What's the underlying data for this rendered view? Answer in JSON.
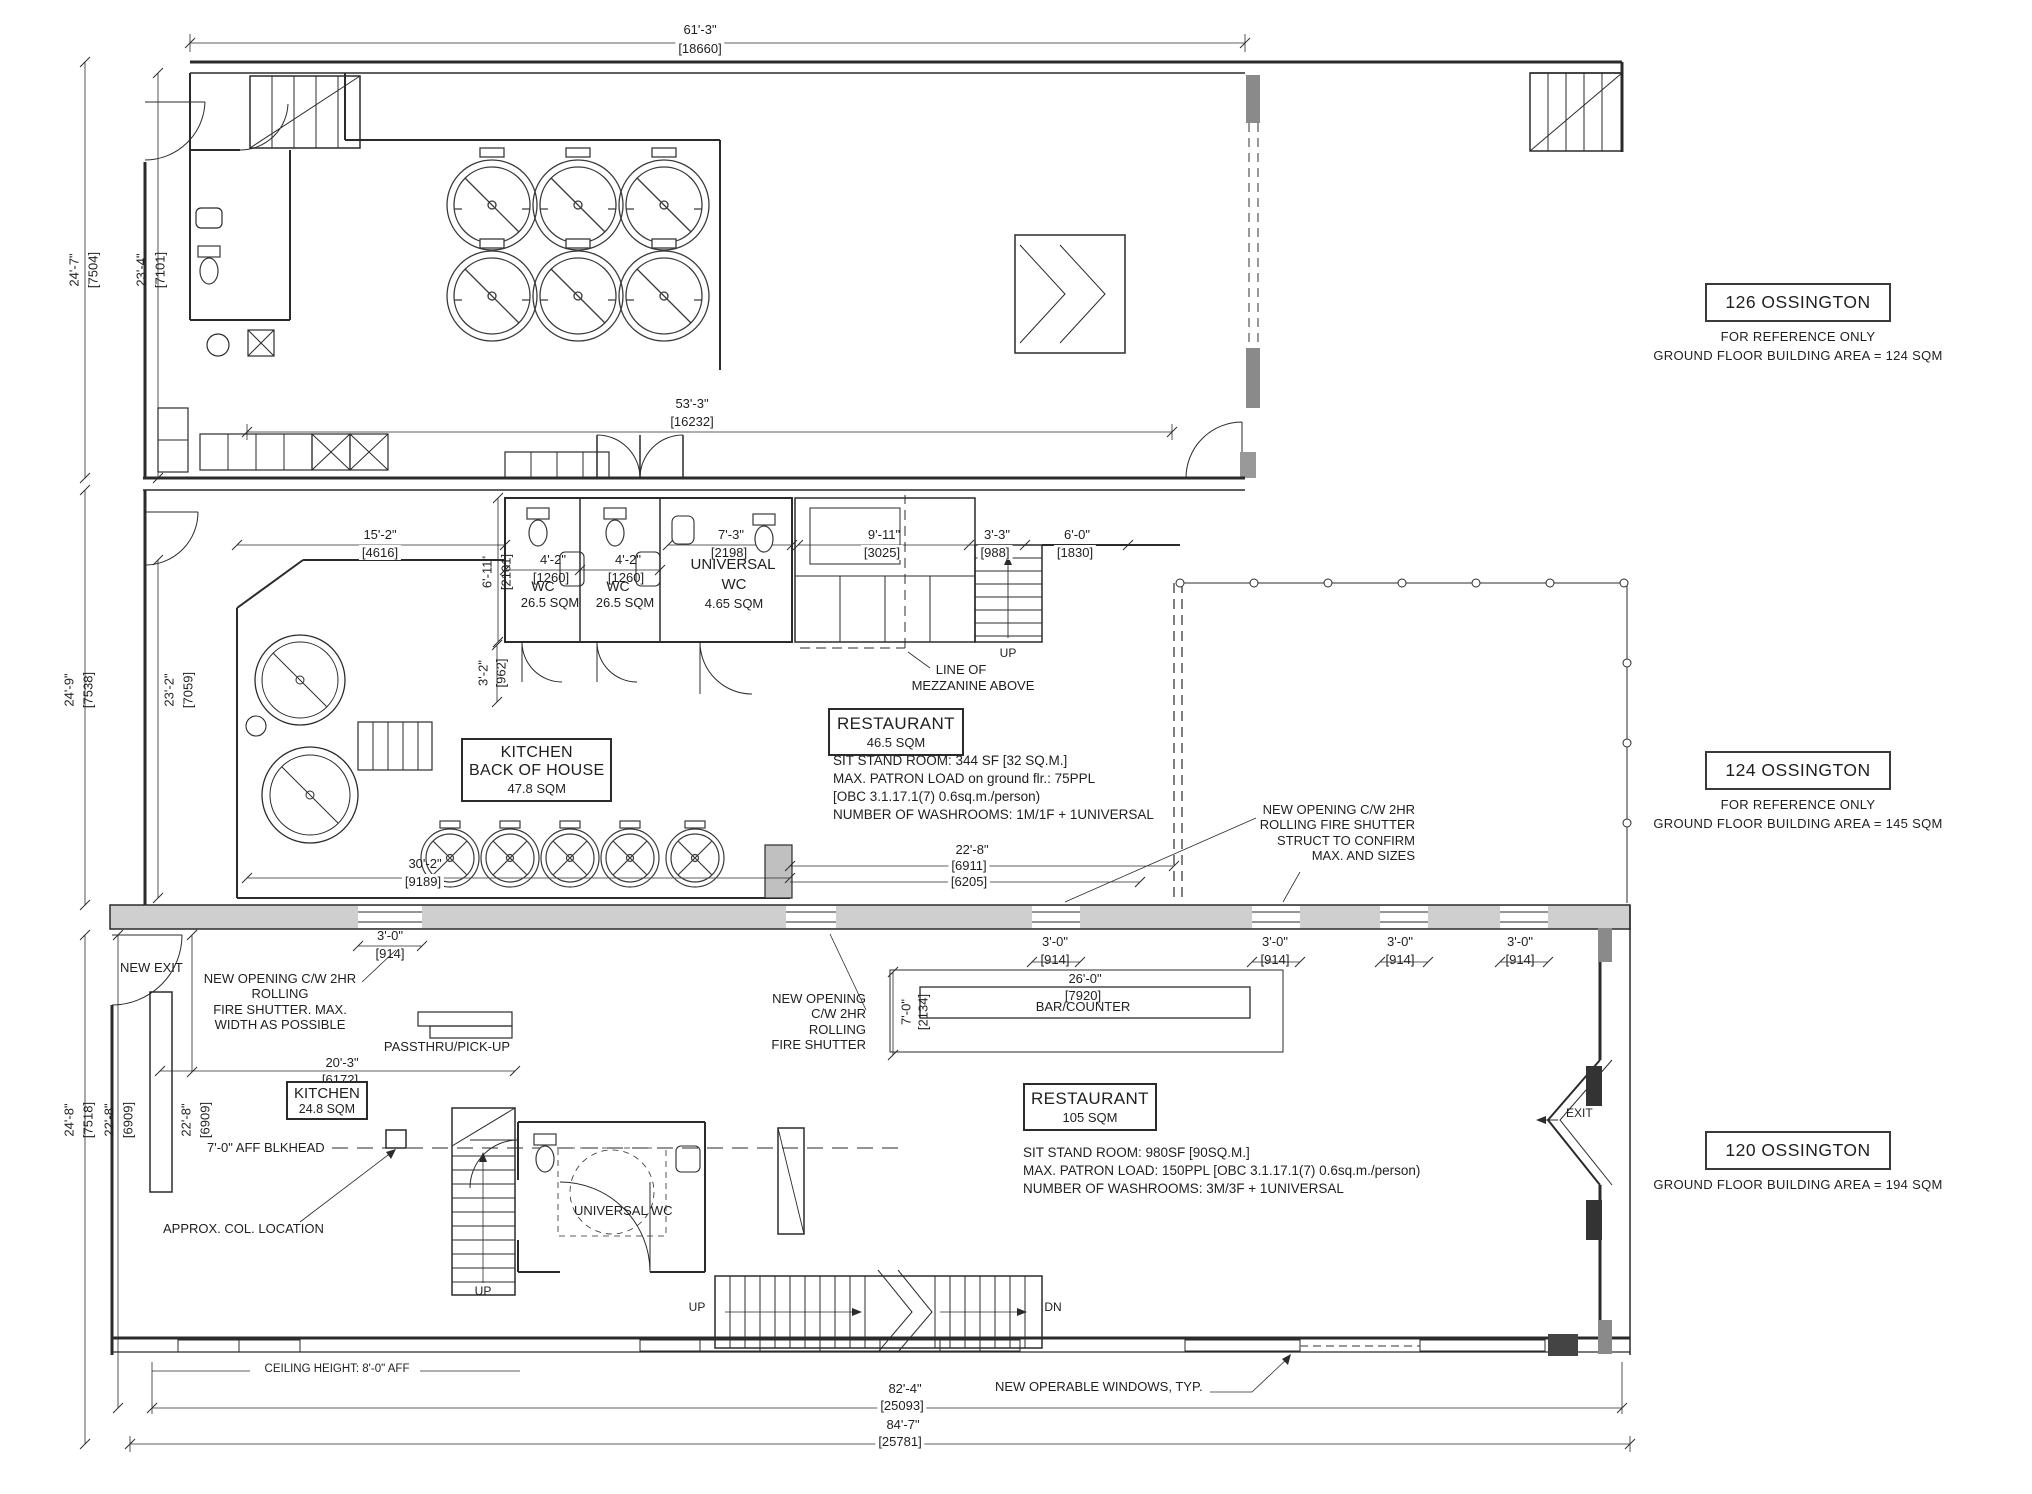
{
  "units": {
    "u126": {
      "name": "126 OSSINGTON",
      "ref": "FOR REFERENCE ONLY",
      "area": "GROUND FLOOR BUILDING AREA = 124 SQM"
    },
    "u124": {
      "name": "124 OSSINGTON",
      "ref": "FOR REFERENCE ONLY",
      "area": "GROUND FLOOR BUILDING AREA = 145 SQM"
    },
    "u120": {
      "name": "120 OSSINGTON",
      "area": "GROUND FLOOR BUILDING AREA = 194 SQM"
    }
  },
  "rooms": {
    "restaurant124": {
      "title": "RESTAURANT",
      "area": "46.5 SQM"
    },
    "restaurant120": {
      "title": "RESTAURANT",
      "area": "105 SQM"
    },
    "kitchen_boh": {
      "l1": "KITCHEN",
      "l2": "BACK OF HOUSE",
      "area": "47.8 SQM"
    },
    "kitchen120": {
      "title": "KITCHEN",
      "area": "24.8 SQM"
    },
    "wc": {
      "title": "WC",
      "area": "26.5 SQM"
    },
    "uwc124": {
      "l1": "UNIVERSAL",
      "l2": "WC",
      "area": "4.65 SQM"
    },
    "uwc120": {
      "title": "UNIVERSAL WC"
    },
    "bar": {
      "title": "BAR/COUNTER"
    }
  },
  "notes": {
    "n124": [
      "SIT STAND ROOM: 344 SF [32 SQ.M.]",
      "MAX. PATRON LOAD on ground flr.: 75PPL",
      "[OBC 3.1.17.1(7) 0.6sq.m./person)",
      "NUMBER OF WASHROOMS: 1M/1F + 1UNIVERSAL"
    ],
    "n120": [
      "SIT STAND ROOM: 980SF [90SQ.M.]",
      "MAX. PATRON LOAD: 150PPL [OBC 3.1.17.1(7) 0.6sq.m./person)",
      "NUMBER OF WASHROOMS: 3M/3F + 1UNIVERSAL"
    ],
    "shutter_struct": [
      "NEW OPENING C/W 2HR",
      "ROLLING FIRE SHUTTER",
      "STRUCT TO CONFIRM",
      "MAX. AND SIZES"
    ],
    "shutter_left": [
      "NEW OPENING C/W 2HR",
      "ROLLING",
      "FIRE SHUTTER. MAX.",
      "WIDTH AS POSSIBLE"
    ],
    "shutter_bar": [
      "NEW OPENING",
      "C/W 2HR",
      "ROLLING",
      "FIRE SHUTTER"
    ],
    "mezz1": "LINE OF",
    "mezz2": "MEZZANINE ABOVE",
    "new_exit": "NEW EXIT",
    "passthru": "PASSTHRU/PICK-UP",
    "blkhead": "7'-0\" AFF BLKHEAD",
    "col": "APPROX. COL. LOCATION",
    "windows": "NEW OPERABLE WINDOWS, TYP.",
    "ceiling": "CEILING HEIGHT: 8'-0\" AFF",
    "up": "UP",
    "dn": "DN",
    "exit": "EXIT"
  },
  "dims": {
    "w61_3": {
      "ft": "61'-3\"",
      "mm": "[18660]"
    },
    "w53_3": {
      "ft": "53'-3\"",
      "mm": "[16232]"
    },
    "h24_7": {
      "ft": "24'-7\"",
      "mm": "[7504]"
    },
    "h23_4": {
      "ft": "23'-4\"",
      "mm": "[7101]"
    },
    "h24_9": {
      "ft": "24'-9\"",
      "mm": "[7538]"
    },
    "h23_2": {
      "ft": "23'-2\"",
      "mm": "[7059]"
    },
    "h24_8": {
      "ft": "24'-8\"",
      "mm": "[7518]"
    },
    "h22_8": {
      "ft": "22'-8\"",
      "mm": "[6909]"
    },
    "w15_2": {
      "ft": "15'-2\"",
      "mm": "[4616]"
    },
    "h6_11": {
      "ft": "6'-11\"",
      "mm": "[2101]"
    },
    "w4_2": {
      "ft": "4'-2\"",
      "mm": "[1260]"
    },
    "w7_3": {
      "ft": "7'-3\"",
      "mm": "[2198]"
    },
    "w9_11": {
      "ft": "9'-11\"",
      "mm": "[3025]"
    },
    "w3_3": {
      "ft": "3'-3\"",
      "mm": "[988]"
    },
    "w6_0": {
      "ft": "6'-0\"",
      "mm": "[1830]"
    },
    "h3_2": {
      "ft": "3'-2\"",
      "mm": "[962]"
    },
    "w30_2": {
      "ft": "30'-2\"",
      "mm": "[9189]"
    },
    "w22_8b": {
      "ft": "22'-8\"",
      "mm": "[6911]",
      "mm2": "[6205]"
    },
    "w3_0": {
      "ft": "3'-0\"",
      "mm": "[914]"
    },
    "w26_0": {
      "ft": "26'-0\"",
      "mm": "[7920]"
    },
    "h7_0": {
      "ft": "7'-0\"",
      "mm": "[2134]"
    },
    "w20_3": {
      "ft": "20'-3\"",
      "mm": "[6172]"
    },
    "w82_4": {
      "ft": "82'-4\"",
      "mm": "[25093]"
    },
    "w84_7": {
      "ft": "84'-7\"",
      "mm": "[25781]"
    }
  },
  "colors": {
    "line": "#2b2b2b",
    "wall_fill": "#cfcfcf",
    "pier_fill": "#8a8a8a",
    "paper": "#ffffff"
  }
}
